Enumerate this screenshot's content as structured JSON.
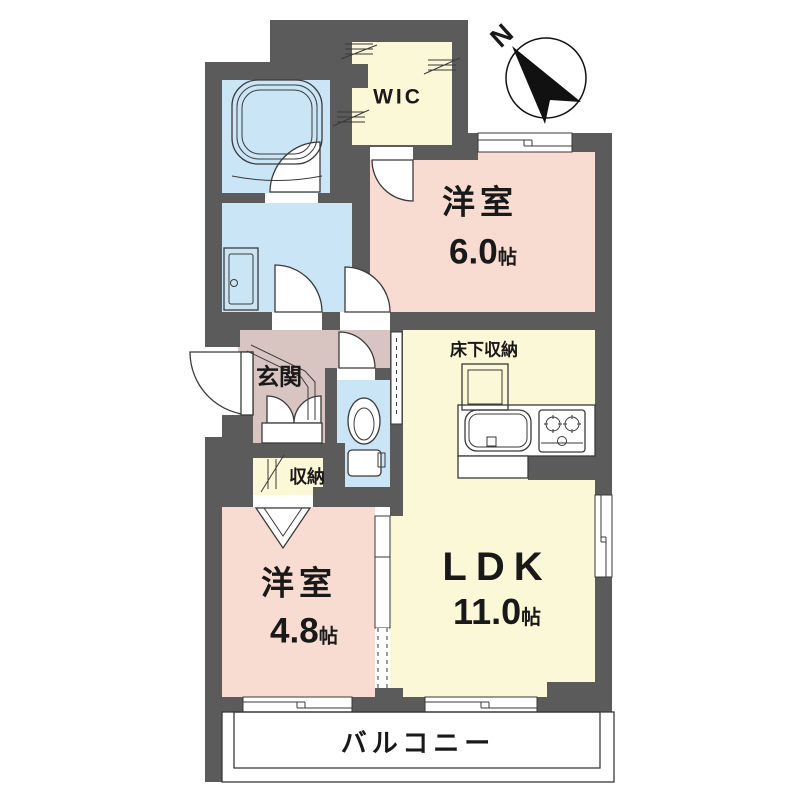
{
  "compass": {
    "north_label": "N"
  },
  "rooms": {
    "wic": {
      "label": "WIC"
    },
    "bedroom_6": {
      "type": "洋室",
      "size": "6.0",
      "unit": "帖"
    },
    "ldk": {
      "type": "LDK",
      "size": "11.0",
      "unit": "帖"
    },
    "bedroom_4_8": {
      "type": "洋室",
      "size": "4.8",
      "unit": "帖"
    },
    "entrance": {
      "label": "玄関"
    },
    "closet": {
      "label": "収納"
    },
    "underfloor_storage": {
      "label": "床下収納"
    },
    "balcony": {
      "label": "バルコニー"
    }
  },
  "colors": {
    "wall": "#5b5b5b",
    "bedroom": "#f8dcd1",
    "ldk_room": "#fbf8d8",
    "wet_area": "#c9e5f6",
    "entrance_hall": "#d8c5c1",
    "line": "#3a3a3a"
  }
}
